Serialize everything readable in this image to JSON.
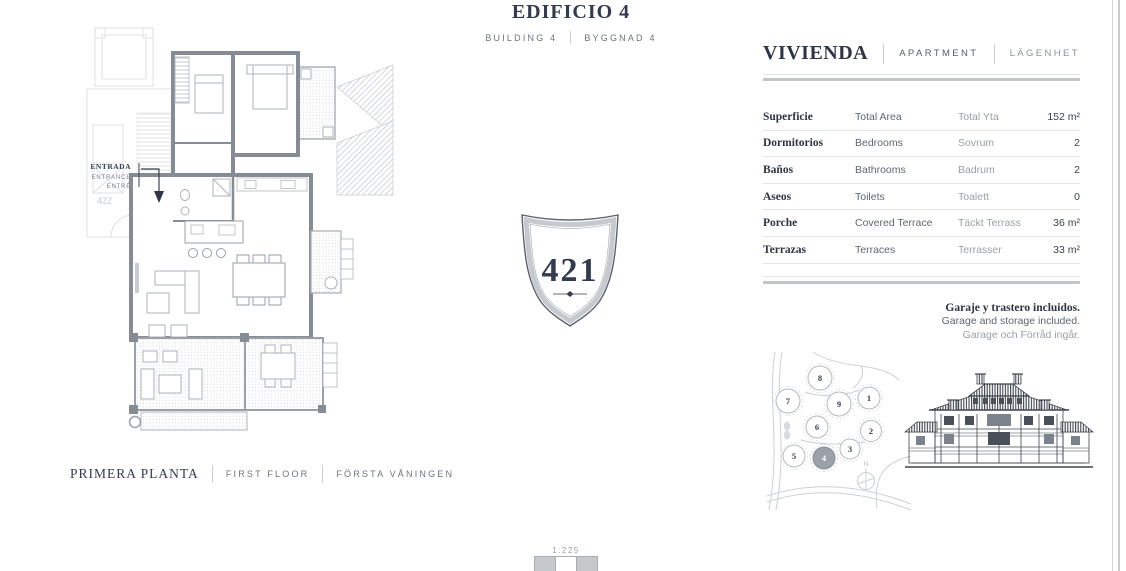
{
  "header": {
    "title": "EDIFICIO 4",
    "subtitle_en": "BUILDING 4",
    "subtitle_sv": "BYGGNAD 4"
  },
  "floor_plan": {
    "entrance": {
      "es": "ENTRADA",
      "en": "ENTRANCE",
      "sv": "ENTRÉ"
    },
    "neighbor_unit_label": "422",
    "caption": {
      "es": "PRIMERA PLANTA",
      "en": "FIRST FLOOR",
      "sv": "FÖRSTA VÅNINGEN"
    }
  },
  "badge": {
    "number": "421"
  },
  "unit_panel": {
    "title": {
      "es": "VIVIENDA",
      "en": "APARTMENT",
      "sv": "LÄGENHET"
    },
    "table": {
      "rows": [
        {
          "es": "Superficie",
          "en": "Total Area",
          "sv": "Total Yta",
          "value": "152 m²"
        },
        {
          "es": "Dormitorios",
          "en": "Bedrooms",
          "sv": "Sovrum",
          "value": "2"
        },
        {
          "es": "Baños",
          "en": "Bathrooms",
          "sv": "Badrum",
          "value": "2"
        },
        {
          "es": "Aseos",
          "en": "Toilets",
          "sv": "Toalett",
          "value": "0"
        },
        {
          "es": "Porche",
          "en": "Covered Terrace",
          "sv": "Täckt Terrass",
          "value": "36 m²"
        },
        {
          "es": "Terrazas",
          "en": "Terraces",
          "sv": "Terrasser",
          "value": "33 m²"
        }
      ]
    },
    "note": {
      "es": "Garaje y trastero incluidos.",
      "en": "Garage and storage included.",
      "sv": "Garage och Förråd ingår."
    }
  },
  "site_plan": {
    "buildings": [
      {
        "label": "1"
      },
      {
        "label": "2"
      },
      {
        "label": "3"
      },
      {
        "label": "4"
      },
      {
        "label": "5"
      },
      {
        "label": "6"
      },
      {
        "label": "7"
      },
      {
        "label": "8"
      },
      {
        "label": "9"
      }
    ],
    "highlighted_building": "4",
    "compass": "N"
  },
  "scale": {
    "label": "1:225"
  },
  "colors": {
    "heading": "#333b4e",
    "text_mid": "#5f666f",
    "text_light": "#999fa7",
    "rule_thin": "#e2e4e7",
    "rule_thick": "#c2c5c9",
    "wall_gray": "#868c95",
    "badge_band": "#c6c9cd"
  }
}
